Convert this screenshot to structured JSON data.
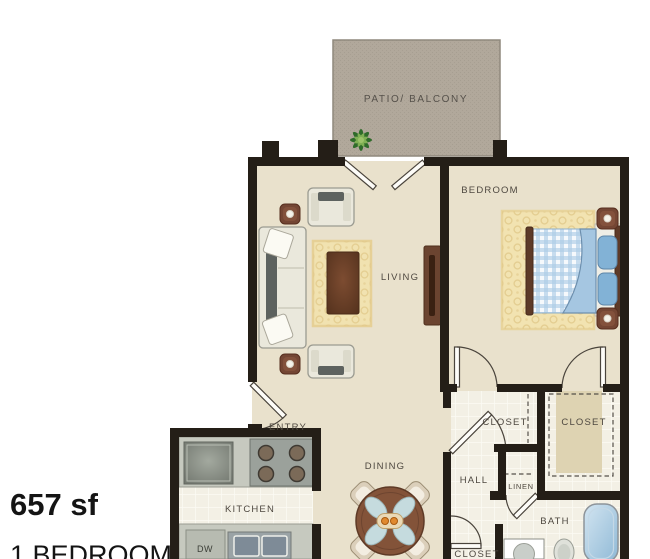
{
  "plan": {
    "rooms": {
      "patio": "PATIO/ BALCONY",
      "bedroom": "BEDROOM",
      "living": "LIVING",
      "entry": "ENTRY",
      "kitchen": "KITCHEN",
      "dining": "DINING",
      "hall": "HALL",
      "closet_bedroom": "CLOSET",
      "closet_walkin": "CLOSET",
      "closet_hall": "CLOSET",
      "linen": "LINEN",
      "bath": "BATH"
    },
    "appliances": {
      "dishwasher": "DW"
    },
    "icons": [
      "plant-icon"
    ],
    "colors": {
      "wall": "#241e17",
      "floor": "#e9e1cc",
      "tile": "#f3f0e5",
      "patio": "#b1a89b",
      "wood_accent": "#744634",
      "bed_blue": "#aecde6",
      "rug_gold": "#f1e2b0",
      "tub_blue": "#9cc2dc",
      "label_text": "#4e4840"
    }
  },
  "info": {
    "area": "657 sf",
    "unit_type": "1 BEDROOM"
  }
}
